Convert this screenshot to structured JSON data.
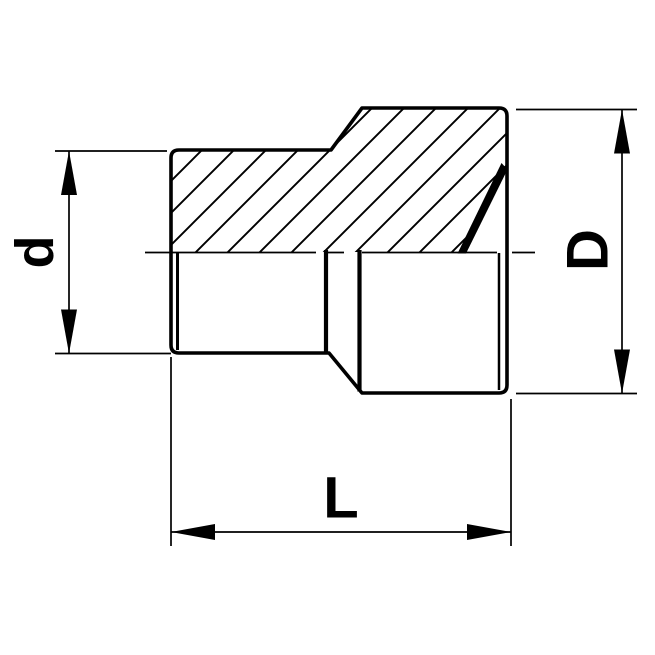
{
  "labels": {
    "small_diameter": "d",
    "large_diameter": "D",
    "length": "L"
  },
  "colors": {
    "line": "#000000",
    "background": "#ffffff"
  }
}
